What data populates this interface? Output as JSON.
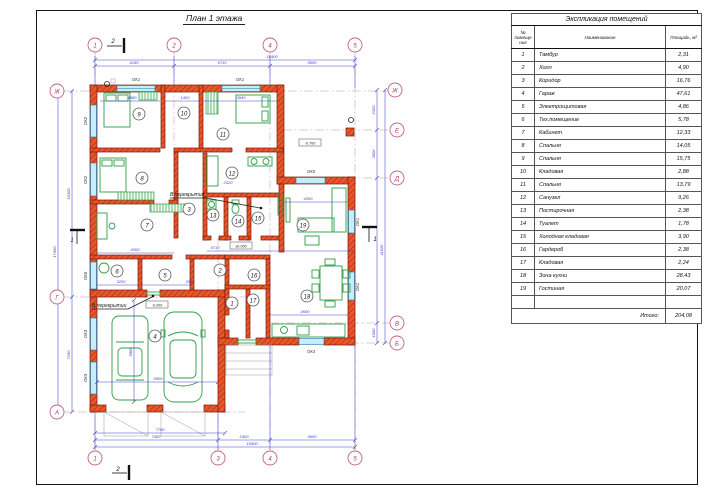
{
  "sheet": {
    "plan_title": "План 1 этажа"
  },
  "table": {
    "title": "Экспликация помещений",
    "col_num": "№ помещения",
    "col_name": "Наименование",
    "col_area": "Площадь, м²",
    "rows": [
      {
        "num": "1",
        "name": "Тамбур",
        "area": "2,31"
      },
      {
        "num": "2",
        "name": "Холл",
        "area": "4,90"
      },
      {
        "num": "3",
        "name": "Коридор",
        "area": "16,76"
      },
      {
        "num": "4",
        "name": "Гараж",
        "area": "47,61"
      },
      {
        "num": "5",
        "name": "Электрощитовая",
        "area": "4,86"
      },
      {
        "num": "6",
        "name": "Тех.помещение",
        "area": "5,78"
      },
      {
        "num": "7",
        "name": "Кабинет",
        "area": "12,33"
      },
      {
        "num": "8",
        "name": "Спальня",
        "area": "14,05"
      },
      {
        "num": "9",
        "name": "Спальня",
        "area": "15,75"
      },
      {
        "num": "10",
        "name": "Кладовая",
        "area": "2,88"
      },
      {
        "num": "11",
        "name": "Спальня",
        "area": "13,79"
      },
      {
        "num": "12",
        "name": "Санузел",
        "area": "9,26"
      },
      {
        "num": "13",
        "name": "Постирочная",
        "area": "2,38"
      },
      {
        "num": "14",
        "name": "Туалет",
        "area": "1,78"
      },
      {
        "num": "15",
        "name": "Холодная кладовая",
        "area": "3,90"
      },
      {
        "num": "16",
        "name": "Гардероб",
        "area": "2,38"
      },
      {
        "num": "17",
        "name": "Кладовая",
        "area": "2,24"
      },
      {
        "num": "18",
        "name": "Зона кухни",
        "area": "28,43"
      },
      {
        "num": "19",
        "name": "Гостиная",
        "area": "20,07"
      }
    ],
    "total_label": "Итого:",
    "total_value": "204,08"
  },
  "plan": {
    "axes": {
      "top": [
        "1",
        "2",
        "4",
        "5"
      ],
      "bottom": [
        "1",
        "3",
        "4",
        "5"
      ],
      "left": [
        "Ж",
        "Г",
        "А"
      ],
      "right": [
        "Ж",
        "Е",
        "Д",
        "В",
        "Б"
      ]
    },
    "rooms": [
      "1",
      "2",
      "3",
      "4",
      "5",
      "6",
      "7",
      "8",
      "9",
      "10",
      "11",
      "12",
      "13",
      "14",
      "15",
      "16",
      "17",
      "18",
      "19"
    ],
    "windows": [
      "ОК1",
      "ОК1",
      "ОК2",
      "ОК2",
      "ОК6",
      "ОК3",
      "ОК3",
      "ОК1",
      "ОК1",
      "ОК5",
      "ОК4"
    ],
    "dims": {
      "top_total": "15400",
      "top": [
        "4150",
        "5710",
        "5600"
      ],
      "bottom_doors": "7700",
      "bottom": [
        "7400",
        "2400",
        "5600"
      ],
      "bottom_total": "15400",
      "left": [
        "10300",
        "7150"
      ],
      "left_total": "17450",
      "right": [
        "2320",
        "3600",
        "11620",
        "1000"
      ],
      "garage_width": "6900",
      "garage_depth": "5985",
      "interior": [
        "4580",
        "1400",
        "3940",
        "2520",
        "4300",
        "3200",
        "2550",
        "5710",
        "4300",
        "4500"
      ]
    },
    "levels": [
      "±0.000",
      "-0.200",
      "-0.700"
    ],
    "notes": [
      "В перекрытии",
      "В перекрытии"
    ],
    "sections": [
      "2",
      "2",
      "1",
      "1"
    ],
    "colors": {
      "wall": "#e8552e",
      "window": "#c7eef6",
      "furniture": "#2f9e44",
      "dimension": "#4545cf",
      "axis": "#c2637e"
    }
  }
}
